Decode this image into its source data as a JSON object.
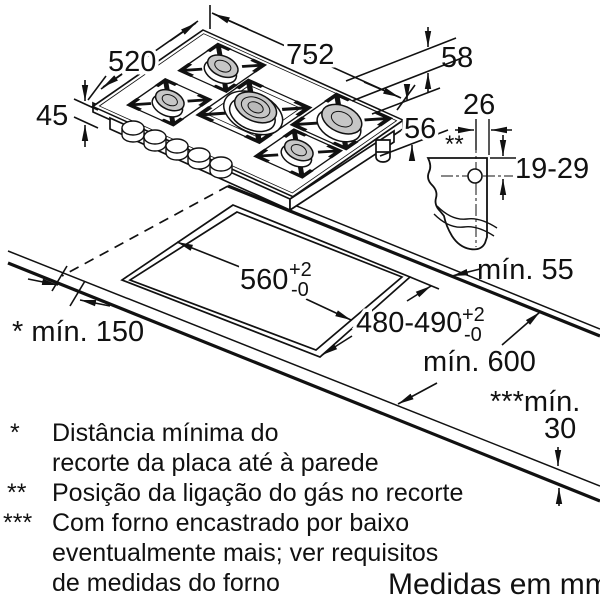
{
  "diagram": {
    "title_hint": "Gas hob installation drawing",
    "hob_dims": {
      "width": "752",
      "depth": "520",
      "height_front": "45",
      "height_edge": "58",
      "height_body": "56"
    },
    "gas_detail": {
      "offset": "26",
      "range": "19-29",
      "marker": "**"
    },
    "cutout": {
      "width": "560",
      "width_tol_plus": "+2",
      "width_tol_minus": "-0",
      "depth": "480-490",
      "depth_tol_plus": "+2",
      "depth_tol_minus": "-0",
      "min_wall": "* mín. 150",
      "min_rear": "mín. 55",
      "min_counter": "mín. 600",
      "min_below_label": "***mín.",
      "min_below_value": "30"
    },
    "footnotes": {
      "star1": "*",
      "line1": "Distância mínima do",
      "line2": "recorte da placa até à parede",
      "star2": "**",
      "line3": "Posição da ligação do gás no recorte",
      "star3": "***",
      "line4": "Com forno encastrado por baixo",
      "line5": "eventualmente mais; ver requisitos",
      "line6": "de medidas do forno"
    },
    "units_note": "Medidas em mm",
    "colors": {
      "line": "#111111",
      "burner_fill": "#c6c6c6",
      "background": "#ffffff"
    }
  }
}
